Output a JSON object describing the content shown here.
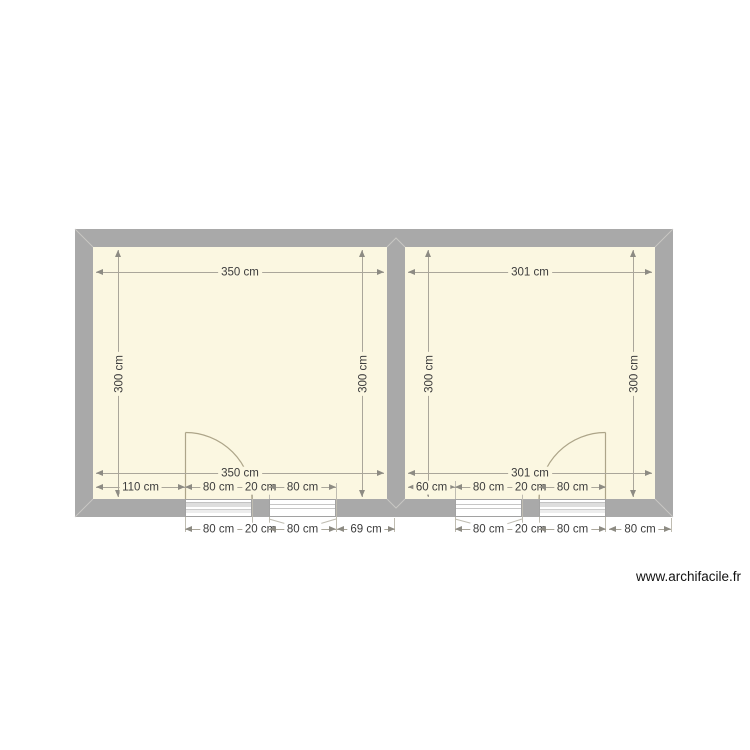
{
  "watermark": "www.archifacile.fr",
  "plan": {
    "left_room": {
      "width_top": "350 cm",
      "width_bottom": "350 cm",
      "height_left": "300 cm",
      "height_right": "300 cm",
      "bottom_inner_segments": [
        "110 cm",
        "80 cm",
        "20 cm",
        "80 cm"
      ],
      "bottom_outer_segments": [
        "80 cm",
        "20 cm",
        "80 cm",
        "69 cm"
      ]
    },
    "right_room": {
      "width_top": "301 cm",
      "width_bottom": "301 cm",
      "height_left": "300 cm",
      "height_right": "300 cm",
      "bottom_inner_segments": [
        "60 cm",
        "80 cm",
        "20 cm",
        "80 cm"
      ],
      "bottom_outer_segments": [
        "80 cm",
        "20 cm",
        "80 cm",
        "80 cm"
      ]
    }
  },
  "colors": {
    "wall": "#a9a9a9",
    "room_fill": "#fbf7e1",
    "dimension_line": "#aaa69a",
    "arrow": "#8d8b83",
    "label_text": "#3c3c3c"
  }
}
